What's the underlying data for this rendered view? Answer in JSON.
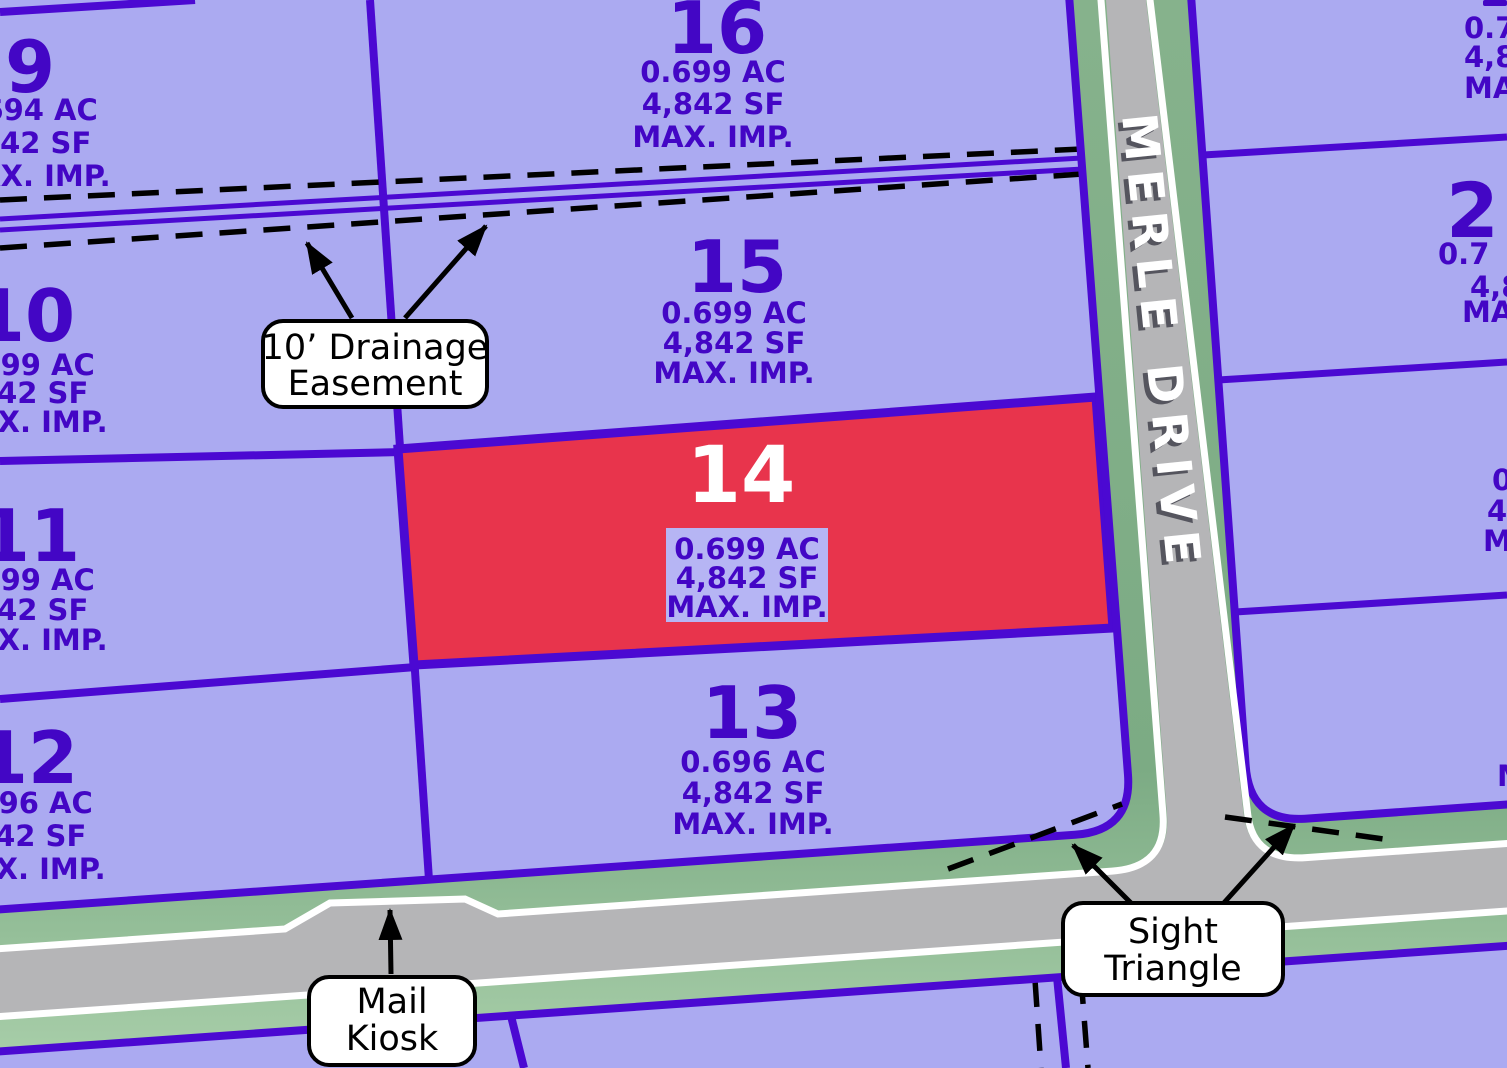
{
  "street": {
    "name": "MERLE DRIVE"
  },
  "lots": {
    "9": {
      "number": "9",
      "ac": "0.694 AC",
      "sf": "4,842 SF",
      "imp": "MAX. IMP."
    },
    "10": {
      "number": "10",
      "ac": "0.699 AC",
      "sf": "4,842 SF",
      "imp": "MAX. IMP."
    },
    "11": {
      "number": "11",
      "ac": "0.699 AC",
      "sf": "4,842 SF",
      "imp": "MAX. IMP."
    },
    "12": {
      "number": "12",
      "ac": "0.696 AC",
      "sf": "4,842 SF",
      "imp": "MAX. IMP."
    },
    "13": {
      "number": "13",
      "ac": "0.696 AC",
      "sf": "4,842 SF",
      "imp": "MAX. IMP."
    },
    "14": {
      "number": "14",
      "ac": "0.699 AC",
      "sf": "4,842 SF",
      "imp": "MAX. IMP.",
      "highlighted": true
    },
    "15": {
      "number": "15",
      "ac": "0.699 AC",
      "sf": "4,842 SF",
      "imp": "MAX. IMP."
    },
    "16": {
      "number": "16",
      "ac": "0.699 AC",
      "sf": "4,842 SF",
      "imp": "MAX. IMP."
    }
  },
  "partial_lots": {
    "top_right": {
      "ac": "0.7",
      "sf": "4,8",
      "imp": "MAX"
    },
    "mid_right": {
      "number": "2",
      "ac": "0.7",
      "sf": "4,8",
      "imp": "MAX"
    },
    "lower_right": {
      "ac": "0.",
      "sf": "4,",
      "imp": "MA"
    },
    "bottom_right": {
      "imp": "M"
    }
  },
  "callouts": {
    "drainage": {
      "line1": "10’ Drainage",
      "line2": "Easement"
    },
    "mail_kiosk": {
      "line1": "Mail",
      "line2": "Kiosk"
    },
    "sight_triangle": {
      "line1": "Sight",
      "line2": "Triangle"
    }
  },
  "colors": {
    "lotFill": "#abaaf1",
    "lotLine": "#4b09d2",
    "lotText": "#4306c5",
    "highlightFill": "#e8344c",
    "highlightText": "#ffffff",
    "statsBoxFill": "#b6b5f4",
    "roadGray": "#b5b5b7",
    "roadEdgeWhite": "#ffffff",
    "greenStrip": "#8cbb91",
    "calloutBg": "#ffffff",
    "calloutText": "#000000",
    "streetNameColor": "#ffffff"
  }
}
